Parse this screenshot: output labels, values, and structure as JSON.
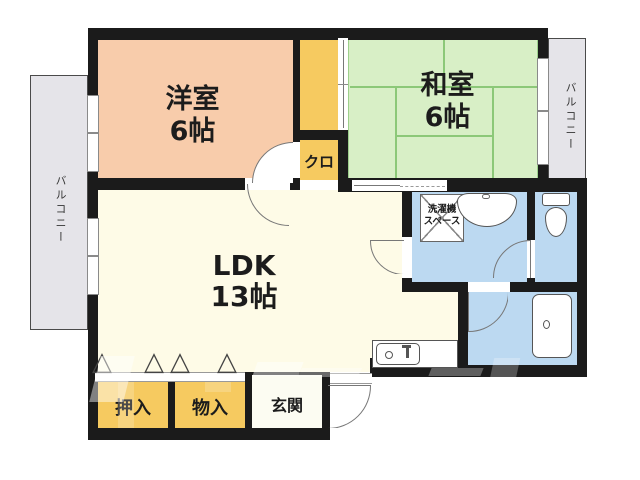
{
  "plan": {
    "type": "apartment-floor-plan",
    "rooms": {
      "western_room": {
        "label": "洋室",
        "size": "6帖"
      },
      "japanese_room": {
        "label": "和室",
        "size": "6帖"
      },
      "ldk": {
        "label": "LDK",
        "size": "13帖"
      },
      "closet_kuro": {
        "label": "クロ"
      },
      "oshiire": {
        "label": "押入"
      },
      "monoire": {
        "label": "物入"
      },
      "genkan": {
        "label": "玄関"
      },
      "laundry_space": {
        "label_line1": "洗濯機",
        "label_line2": "スペース"
      },
      "balcony_left": {
        "label": "バルコニー"
      },
      "balcony_right": {
        "label": "バルコニー"
      }
    },
    "colors": {
      "wall": "#1b1b1b",
      "western_room": "#f8ccab",
      "japanese_room": "#d8efc6",
      "tatami_line": "#8cc878",
      "closet_yellow": "#f6ca60",
      "ldk_cream": "#fefbe7",
      "wet_area_blue": "#bcd9f1",
      "balcony_gray": "#e5e4e9",
      "genkan_white": "#fcfcf2"
    },
    "icons": {
      "folding_door": "△"
    }
  }
}
